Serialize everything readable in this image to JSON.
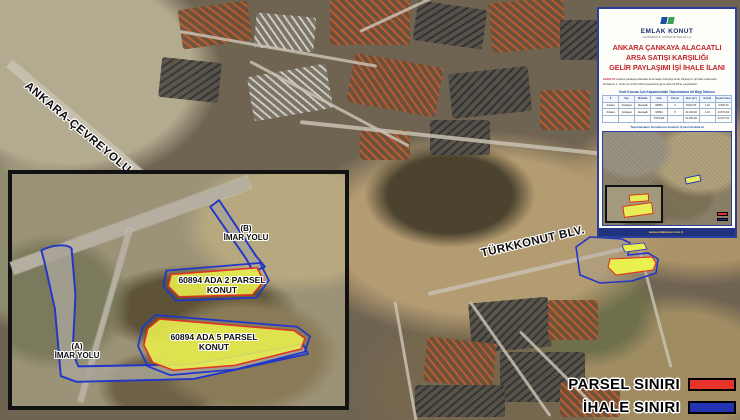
{
  "map": {
    "road_labels": {
      "ring_road": "ANKARA-ÇEVREYOLU",
      "boulevard": "TÜRKKONUT BLV."
    },
    "legend": {
      "items": [
        {
          "label": "PARSEL SINIRI",
          "color": "#e8332b"
        },
        {
          "label": "İHALE SINIRI",
          "color": "#2433b4"
        }
      ]
    }
  },
  "inset": {
    "labels": {
      "road_a": {
        "line1": "(A)",
        "line2": "İMAR YOLU"
      },
      "road_b": {
        "line1": "(B)",
        "line2": "İMAR YOLU"
      },
      "parcel_2": {
        "line1": "60894 ADA 2 PARSEL",
        "line2": "KONUT"
      },
      "parcel_5": {
        "line1": "60894 ADA 5 PARSEL",
        "line2": "KONUT"
      }
    },
    "colors": {
      "parcel_fill": "#eaf04e",
      "parcel_stroke": "#e23222",
      "tender_stroke": "#2236c8"
    }
  },
  "panel": {
    "brand": {
      "name": "EMLAK KONUT",
      "tagline": "GAYRİMENKUL YATIRIM ORTAKLIĞI A.Ş."
    },
    "title_lines": [
      "ANKARA ÇANKAYA ALACAATLI",
      "ARSA SATIŞI KARŞILIĞI",
      "GELİR PAYLAŞIMI İŞİ İHALE İLANI"
    ],
    "title_color": "#c1272d",
    "bullets": [
      {
        "lead": "EKGYO",
        "text": "Ankara Çankaya Alacaatlı Arsa Satışı Karşılığı Gelir Paylaşımı İşi ihale edilecektir."
      },
      {
        "lead": "",
        "text": "İhalenin 1. Oturumu 23.01.2024 Çarşamba günü saat 15.00'te yapılacaktır."
      }
    ],
    "table": {
      "title": "İhale Konusu İşin Kapsamındaki Taşınmazlara Ait Bilgi Tablosu",
      "columns": [
        "İl",
        "İlçe",
        "Mahalle",
        "Ada",
        "Parsel",
        "Alan (m²)",
        "Emsal",
        "İnşaat Alanı (m²)"
      ],
      "rows": [
        [
          "Ankara",
          "Çankaya",
          "Alacaatlı",
          "60894",
          "2",
          "8.912,00",
          "1,10",
          "9.803,20"
        ],
        [
          "Ankara",
          "Çankaya",
          "Alacaatlı",
          "60894",
          "5",
          "22.340,00",
          "1,10",
          "24.574,00"
        ],
        [
          "",
          "",
          "",
          "TOPLAM",
          "",
          "31.252,00",
          "",
          "34.377,20"
        ]
      ]
    },
    "caption": "Taşınmazların Konumunu Gösterir Uydu Görüntüsü",
    "footer": {
      "site": "www.emlakkonut.com.tr",
      "rest": ""
    }
  }
}
